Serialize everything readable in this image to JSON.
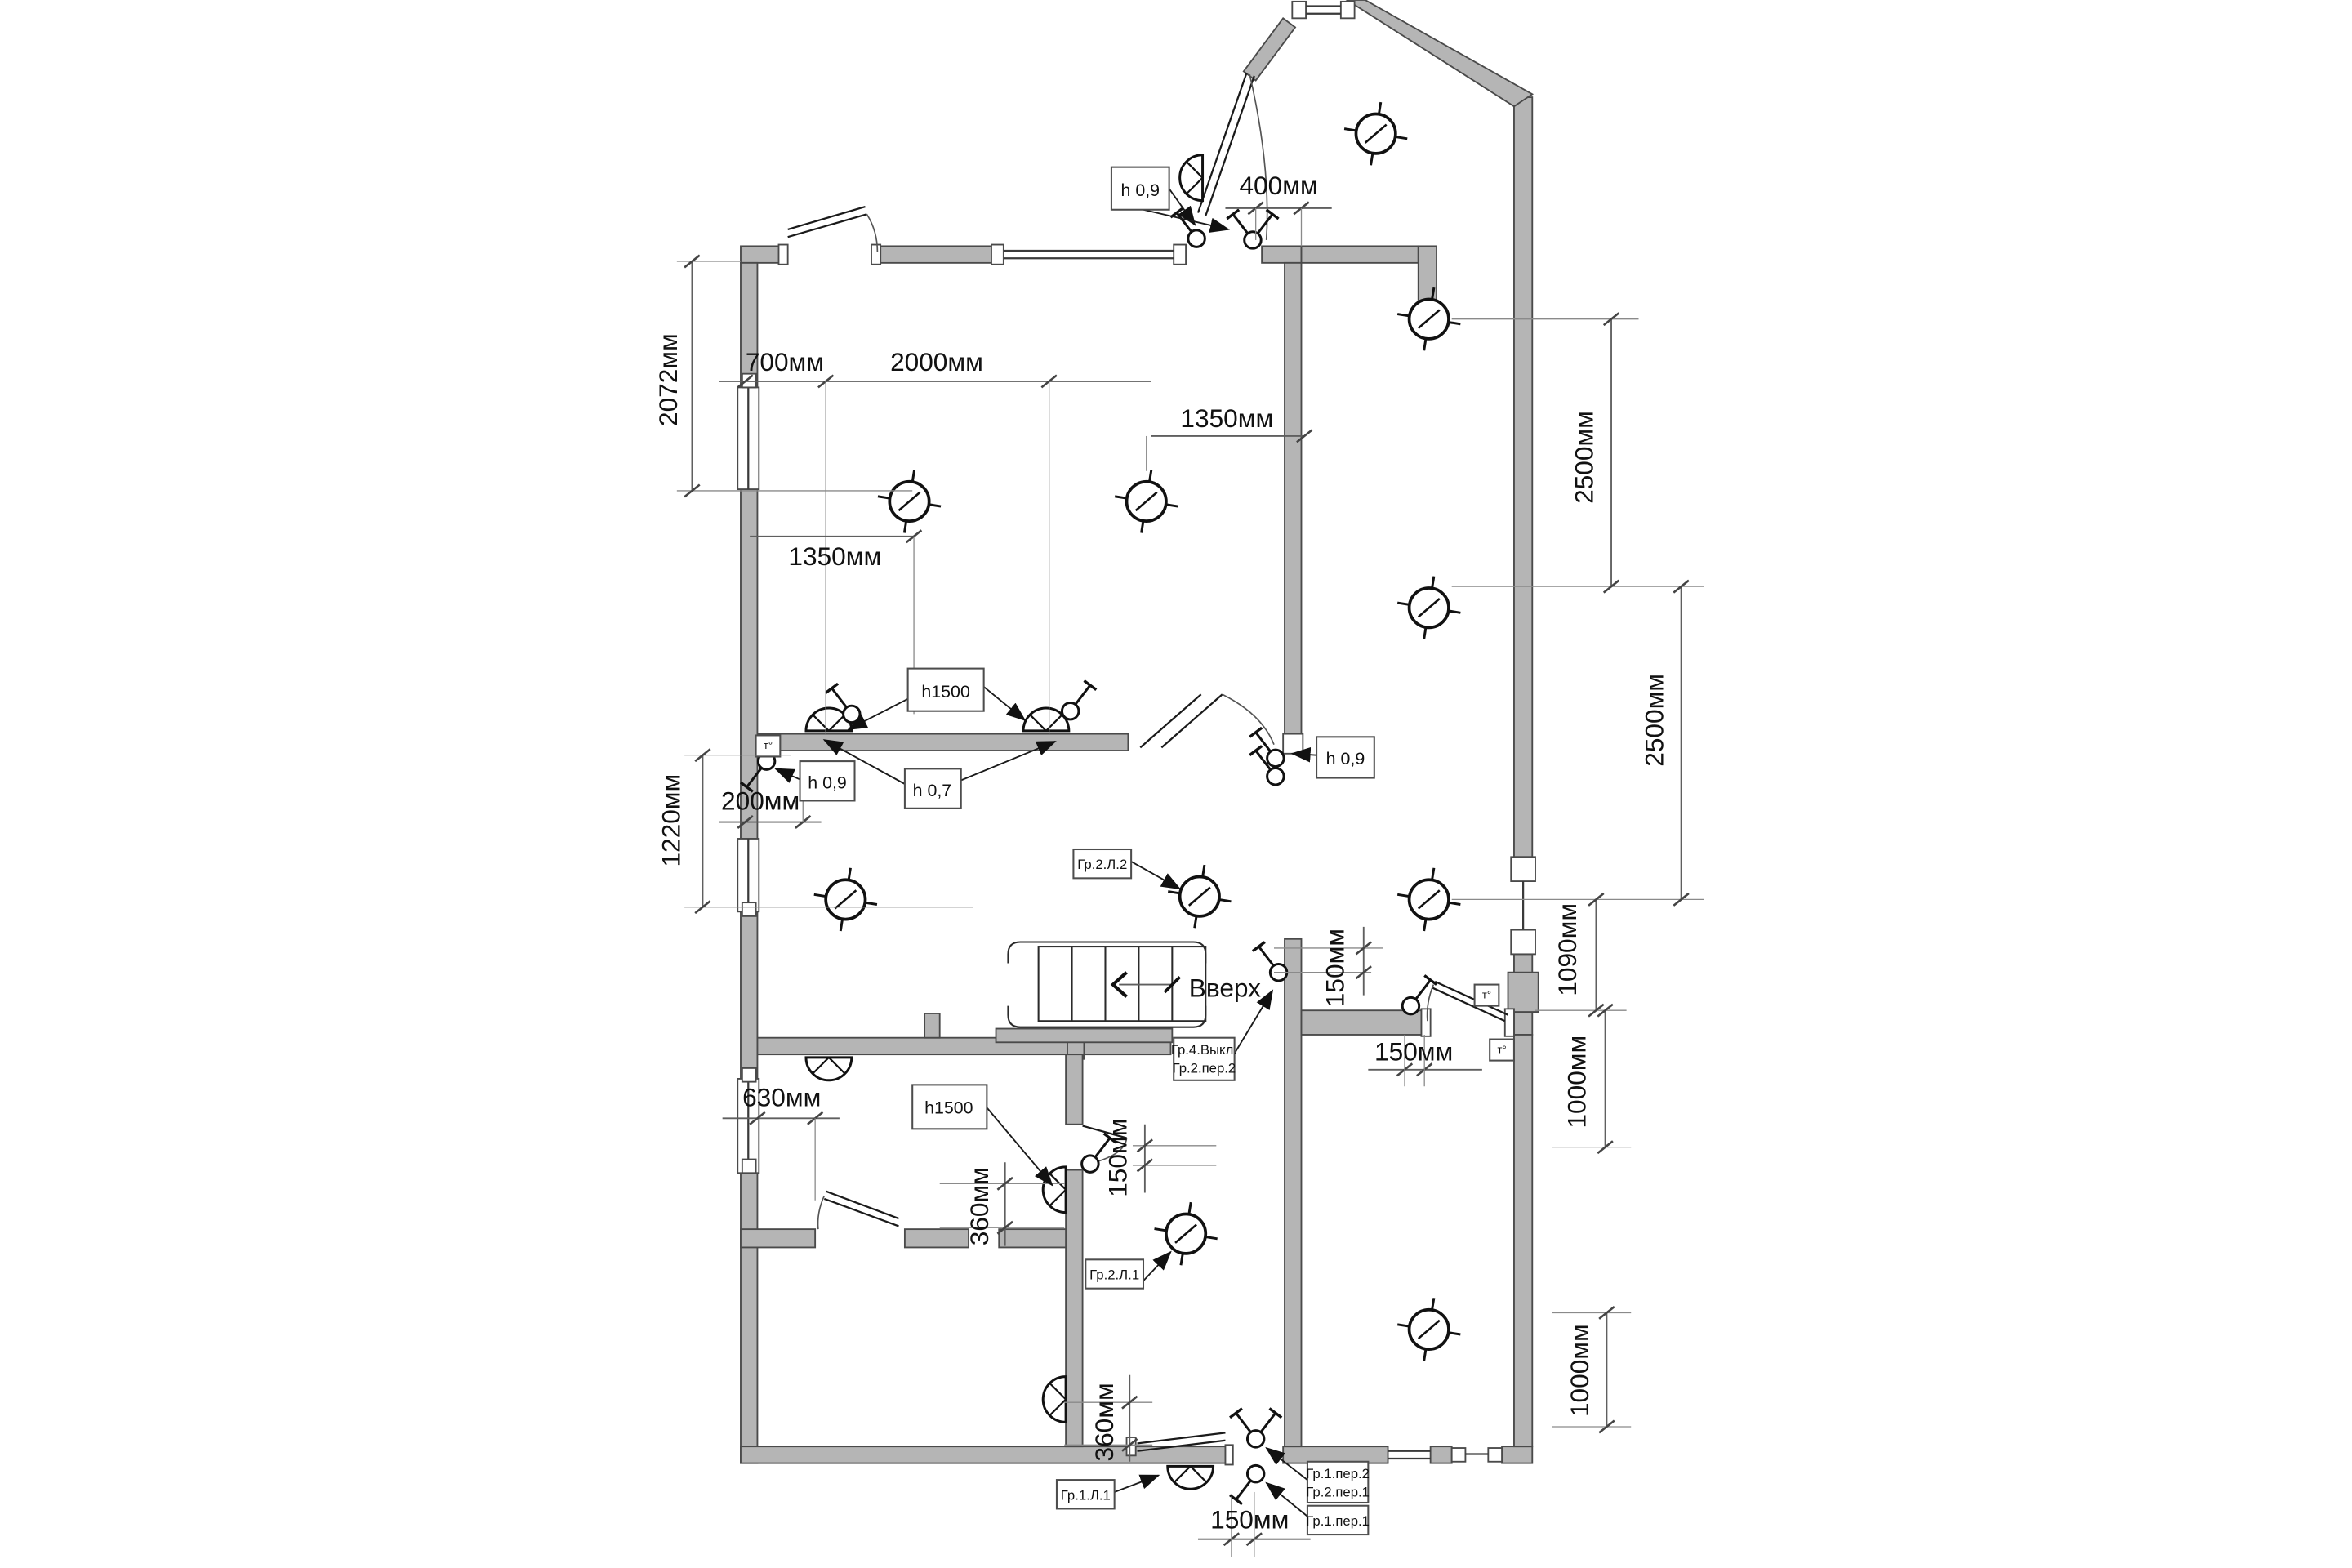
{
  "colors": {
    "wall_fill": "#b5b5b5",
    "wall_outline": "#4a4a4a",
    "line": "#1a1a1a",
    "dimension": "#5f5f5f",
    "background": "#ffffff"
  },
  "labels": {
    "h09_top": "h 0,9",
    "h09_left": "h 0,9",
    "h09_right": "h 0,9",
    "h07": "h 0,7",
    "h1500_top": "h1500",
    "h1500_bottom": "h1500",
    "gr2l2": "Гр.2.Л.2",
    "gr2l1": "Гр.2.Л.1",
    "gr1l1": "Гр.1.Л.1",
    "gr4_line1": "Гр.4.Выкл.",
    "gr4_line2": "Гр.2.пер.2",
    "per_line1": "Гр.1.пер.2",
    "per_line2": "Гр.2.пер.1",
    "per11": "Гр.1.пер.1",
    "thermostat": "т°"
  },
  "dimensions": {
    "d2072": "2072мм",
    "d700": "700мм",
    "d2000": "2000мм",
    "d1350_right": "1350мм",
    "d1350_left": "1350мм",
    "d400": "400мм",
    "d1220": "1220мм",
    "d200": "200мм",
    "d2500_upper": "2500мм",
    "d2500_lower": "2500мм",
    "d1090": "1090мм",
    "d1000_upper": "1000мм",
    "d1000_lower": "1000мм",
    "d150_stairs": "150мм",
    "d150_door_right": "150мм",
    "d150_inner": "150мм",
    "d150_bottom": "150мм",
    "d630": "630мм",
    "d360_upper": "360мм",
    "d360_lower": "360мм"
  },
  "annotations": {
    "up": "Вверх"
  }
}
